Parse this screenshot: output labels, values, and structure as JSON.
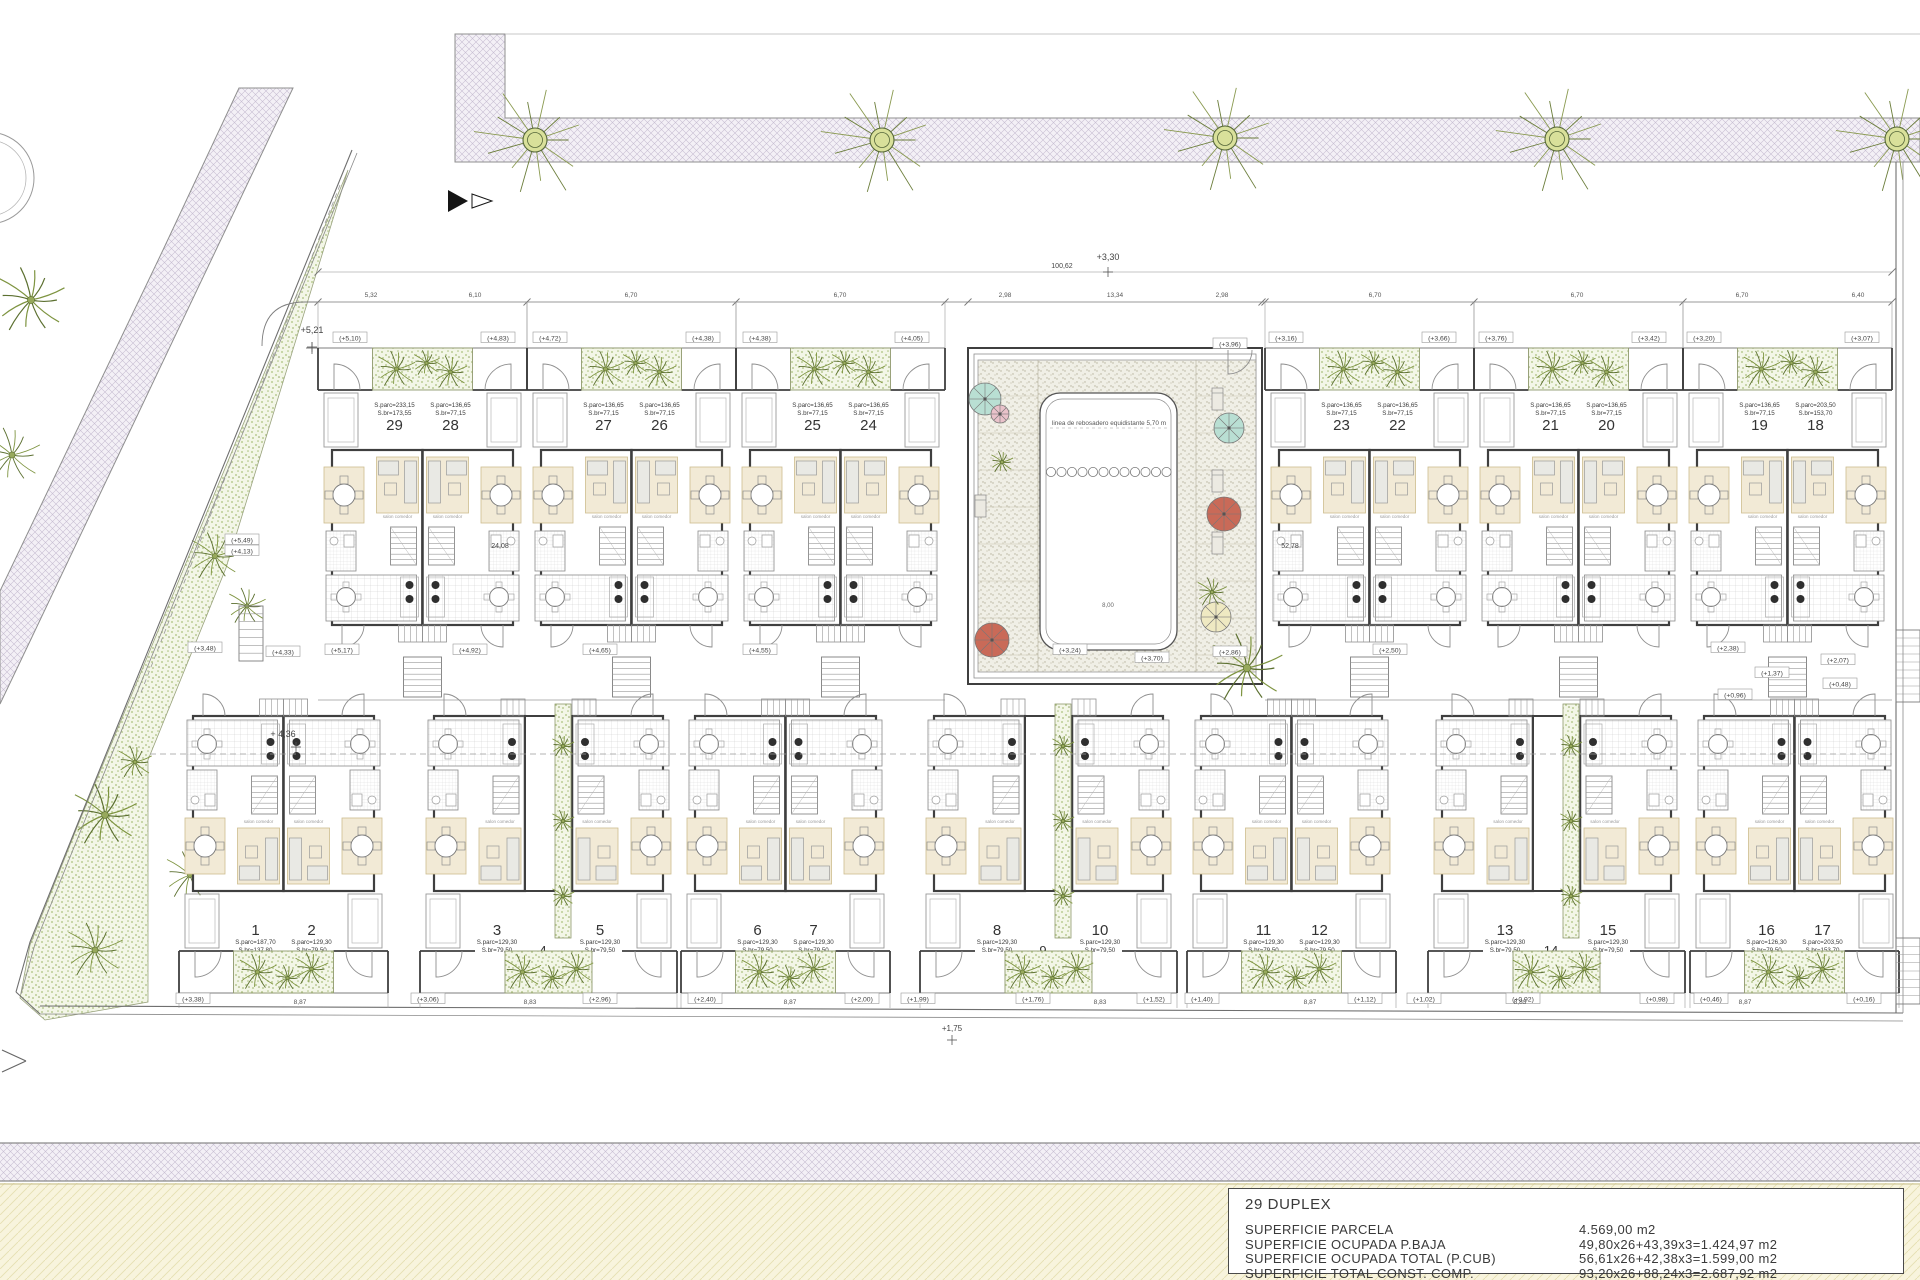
{
  "page": {
    "width": 1920,
    "height": 1280,
    "background": "#ffffff"
  },
  "colors": {
    "wall": "#3f3f3f",
    "line": "#6e6e6e",
    "faint": "#9a9a9a",
    "text": "#3a3a3a",
    "crosshatch_base": "#f3f0f6",
    "crosshatch_line": "#c6bdd2",
    "beige_base": "#f8f4dd",
    "beige_line": "#e6dfb2",
    "green_base": "#f3f6e7",
    "green_dot": "#a9bf7c",
    "plant": "#7e9440",
    "plant_dark": "#5c7030",
    "rug": "#f2ead6",
    "rug_line": "#cdbd8e",
    "deck_base": "#f0efe6",
    "deck_dot": "#b5b19c",
    "pool_edge": "#555555",
    "parasol_teal": "#b9dfd3",
    "parasol_pink": "#e9c2ca",
    "parasol_red": "#c96a58",
    "parasol_yellow": "#efe9c2"
  },
  "title_block": {
    "title": "29 DUPLEX",
    "rows": [
      {
        "label": "SUPERFICIE PARCELA",
        "value": "4.569,00 m2"
      },
      {
        "label": "SUPERFICIE OCUPADA P.BAJA",
        "value": "49,80x26+43,39x3=1.424,97 m2"
      },
      {
        "label": "SUPERFICIE OCUPADA TOTAL (P.CUB)",
        "value": "56,61x26+42,38x3=1.599,00 m2"
      },
      {
        "label": "SUPERFICIE TOTAL CONST. COMP.",
        "value": "93,20x26+88,24x3=2.687,92 m2"
      }
    ]
  },
  "pool": {
    "note": "linea de rebosadero equidistante 5,70 m",
    "dim_inner": "8,00",
    "parasols": [
      {
        "x": 985,
        "y": 399,
        "r": 16,
        "color": "#b9dfd3"
      },
      {
        "x": 1000,
        "y": 414,
        "r": 9,
        "color": "#e9c2ca"
      },
      {
        "x": 1229,
        "y": 428,
        "r": 15,
        "color": "#b9dfd3"
      },
      {
        "x": 1224,
        "y": 514,
        "r": 17,
        "color": "#c96a58"
      },
      {
        "x": 992,
        "y": 640,
        "r": 17,
        "color": "#c96a58"
      },
      {
        "x": 1216,
        "y": 617,
        "r": 15,
        "color": "#efe9c2"
      }
    ],
    "loungers": [
      {
        "x": 1212,
        "y": 388
      },
      {
        "x": 1212,
        "y": 470
      },
      {
        "x": 1212,
        "y": 532
      },
      {
        "x": 975,
        "y": 495
      }
    ],
    "palms": [
      {
        "x": 1247,
        "y": 668,
        "r": 38
      },
      {
        "x": 1212,
        "y": 592,
        "r": 16
      },
      {
        "x": 1002,
        "y": 462,
        "r": 12
      }
    ]
  },
  "street_trees": [
    {
      "x": 535,
      "y": 140
    },
    {
      "x": 882,
      "y": 140
    },
    {
      "x": 1225,
      "y": 138
    },
    {
      "x": 1557,
      "y": 139
    },
    {
      "x": 1897,
      "y": 139
    }
  ],
  "garden_trees": [
    {
      "x": 105,
      "y": 815,
      "r": 34
    },
    {
      "x": 95,
      "y": 950,
      "r": 30
    },
    {
      "x": 190,
      "y": 875,
      "r": 26
    },
    {
      "x": 240,
      "y": 868,
      "r": 22
    },
    {
      "x": 215,
      "y": 556,
      "r": 26
    },
    {
      "x": 247,
      "y": 606,
      "r": 20
    },
    {
      "x": 135,
      "y": 762,
      "r": 18
    },
    {
      "x": 31,
      "y": 300,
      "r": 36
    },
    {
      "x": 12,
      "y": 455,
      "r": 30
    }
  ],
  "blocks": [
    {
      "name": "top-row",
      "y": 345,
      "flip": false,
      "groups": [
        {
          "type": "pair",
          "x": 318,
          "units": [
            {
              "num": "29",
              "a1": "S.parc=233,15",
              "a2": "S.br=173,55"
            },
            {
              "num": "28",
              "a1": "S.parc=136,65",
              "a2": "S.br=77,15"
            }
          ]
        },
        {
          "type": "pair",
          "x": 527,
          "units": [
            {
              "num": "27",
              "a1": "S.parc=136,65",
              "a2": "S.br=77,15"
            },
            {
              "num": "26",
              "a1": "S.parc=136,65",
              "a2": "S.br=77,15"
            }
          ]
        },
        {
          "type": "pair",
          "x": 736,
          "units": [
            {
              "num": "25",
              "a1": "S.parc=136,65",
              "a2": "S.br=77,15"
            },
            {
              "num": "24",
              "a1": "S.parc=136,65",
              "a2": "S.br=77,15"
            }
          ]
        },
        {
          "type": "pair",
          "x": 1265,
          "units": [
            {
              "num": "23",
              "a1": "S.parc=136,65",
              "a2": "S.br=77,15"
            },
            {
              "num": "22",
              "a1": "S.parc=136,65",
              "a2": "S.br=77,15"
            }
          ]
        },
        {
          "type": "pair",
          "x": 1474,
          "units": [
            {
              "num": "21",
              "a1": "S.parc=136,65",
              "a2": "S.br=77,15"
            },
            {
              "num": "20",
              "a1": "S.parc=136,65",
              "a2": "S.br=77,15"
            }
          ]
        },
        {
          "type": "pair",
          "x": 1683,
          "units": [
            {
              "num": "19",
              "a1": "S.parc=136,65",
              "a2": "S.br=77,15"
            },
            {
              "num": "18",
              "a1": "S.parc=203,50",
              "a2": "S.br=153,70"
            }
          ]
        }
      ]
    },
    {
      "name": "bottom-row",
      "y": 996,
      "flip": true,
      "groups": [
        {
          "type": "pair",
          "x": 179,
          "units": [
            {
              "num": "1",
              "a1": "S.parc=187,70",
              "a2": "S.br=137,80"
            },
            {
              "num": "2",
              "a1": "S.parc=129,30",
              "a2": "S.br=79,50"
            }
          ]
        },
        {
          "type": "triple",
          "x": 420,
          "units": [
            {
              "num": "3",
              "a1": "S.parc=129,30",
              "a2": "S.br=79,50"
            },
            {
              "num": "4",
              "a1": "S.parc=88,03",
              "a2": "S.br=42,84"
            },
            {
              "num": "5",
              "a1": "S.parc=129,30",
              "a2": "S.br=79,50"
            }
          ]
        },
        {
          "type": "pair",
          "x": 681,
          "units": [
            {
              "num": "6",
              "a1": "S.parc=129,30",
              "a2": "S.br=79,50"
            },
            {
              "num": "7",
              "a1": "S.parc=129,30",
              "a2": "S.br=79,50"
            }
          ]
        },
        {
          "type": "triple",
          "x": 920,
          "units": [
            {
              "num": "8",
              "a1": "S.parc=129,30",
              "a2": "S.br=79,50"
            },
            {
              "num": "9",
              "a1": "S.parc=88,03",
              "a2": "S.br=42,84"
            },
            {
              "num": "10",
              "a1": "S.parc=129,30",
              "a2": "S.br=79,50"
            }
          ]
        },
        {
          "type": "pair",
          "x": 1187,
          "units": [
            {
              "num": "11",
              "a1": "S.parc=129,30",
              "a2": "S.br=79,50"
            },
            {
              "num": "12",
              "a1": "S.parc=129,30",
              "a2": "S.br=79,50"
            }
          ]
        },
        {
          "type": "triple",
          "x": 1428,
          "units": [
            {
              "num": "13",
              "a1": "S.parc=129,30",
              "a2": "S.br=79,50"
            },
            {
              "num": "14",
              "a1": "S.parc=88,03",
              "a2": "S.br=42,84"
            },
            {
              "num": "15",
              "a1": "S.parc=129,30",
              "a2": "S.br=79,50"
            }
          ]
        },
        {
          "type": "pair",
          "x": 1690,
          "units": [
            {
              "num": "16",
              "a1": "S.parc=126,30",
              "a2": "S.br=79,50"
            },
            {
              "num": "17",
              "a1": "S.parc=203,50",
              "a2": "S.br=153,70"
            }
          ]
        }
      ]
    }
  ],
  "site_labels": [
    {
      "t": "+5,21",
      "x": 312,
      "y": 333,
      "s": 9
    },
    {
      "t": "+3,30",
      "x": 1108,
      "y": 260,
      "s": 9
    },
    {
      "t": "+ 4,36",
      "x": 283,
      "y": 737,
      "s": 9
    },
    {
      "t": "+1,75",
      "x": 952,
      "y": 1031,
      "s": 8
    },
    {
      "t": "100,62",
      "x": 1062,
      "y": 268,
      "s": 7
    },
    {
      "t": "24,08",
      "x": 500,
      "y": 548,
      "s": 7
    },
    {
      "t": "52,78",
      "x": 1290,
      "y": 548,
      "s": 7
    },
    {
      "t": "(+5,10)",
      "x": 350,
      "y": 338,
      "b": 1
    },
    {
      "t": "(+4,83)",
      "x": 498,
      "y": 338,
      "b": 1
    },
    {
      "t": "(+4,72)",
      "x": 550,
      "y": 338,
      "b": 1
    },
    {
      "t": "(+4,38)",
      "x": 703,
      "y": 338,
      "b": 1
    },
    {
      "t": "(+4,38)",
      "x": 760,
      "y": 338,
      "b": 1
    },
    {
      "t": "(+4,05)",
      "x": 912,
      "y": 338,
      "b": 1
    },
    {
      "t": "(+3,96)",
      "x": 1230,
      "y": 344,
      "b": 1
    },
    {
      "t": "(+3,16)",
      "x": 1286,
      "y": 338,
      "b": 1
    },
    {
      "t": "(+3,66)",
      "x": 1439,
      "y": 338,
      "b": 1
    },
    {
      "t": "(+3,76)",
      "x": 1496,
      "y": 338,
      "b": 1
    },
    {
      "t": "(+3,42)",
      "x": 1649,
      "y": 338,
      "b": 1
    },
    {
      "t": "(+3,20)",
      "x": 1704,
      "y": 338,
      "b": 1
    },
    {
      "t": "(+3,07)",
      "x": 1862,
      "y": 338,
      "b": 1
    },
    {
      "t": "(+5,49)",
      "x": 242,
      "y": 540,
      "b": 1
    },
    {
      "t": "(+4,13)",
      "x": 242,
      "y": 551,
      "b": 1
    },
    {
      "t": "(+3,48)",
      "x": 205,
      "y": 648,
      "b": 1
    },
    {
      "t": "(+4,33)",
      "x": 283,
      "y": 652,
      "b": 1
    },
    {
      "t": "(+5,17)",
      "x": 342,
      "y": 650,
      "b": 1
    },
    {
      "t": "(+4,92)",
      "x": 470,
      "y": 650,
      "b": 1
    },
    {
      "t": "(+4,65)",
      "x": 600,
      "y": 650,
      "b": 1
    },
    {
      "t": "(+4,55)",
      "x": 760,
      "y": 650,
      "b": 1
    },
    {
      "t": "(+3,70)",
      "x": 1152,
      "y": 658,
      "b": 1
    },
    {
      "t": "(+3,24)",
      "x": 1070,
      "y": 650,
      "b": 1
    },
    {
      "t": "(+2,86)",
      "x": 1230,
      "y": 652,
      "b": 1
    },
    {
      "t": "(+2,50)",
      "x": 1390,
      "y": 650,
      "b": 1
    },
    {
      "t": "(+2,38)",
      "x": 1728,
      "y": 648,
      "b": 1
    },
    {
      "t": "(+2,07)",
      "x": 1838,
      "y": 660,
      "b": 1
    },
    {
      "t": "(+1,37)",
      "x": 1772,
      "y": 673,
      "b": 1
    },
    {
      "t": "(+0,48)",
      "x": 1840,
      "y": 684,
      "b": 1
    },
    {
      "t": "(+0,96)",
      "x": 1735,
      "y": 695,
      "b": 1
    },
    {
      "t": "(+3,38)",
      "x": 193,
      "y": 999,
      "b": 1
    },
    {
      "t": "(+3,06)",
      "x": 428,
      "y": 999,
      "b": 1
    },
    {
      "t": "(+2,96)",
      "x": 600,
      "y": 999,
      "b": 1
    },
    {
      "t": "(+2,40)",
      "x": 705,
      "y": 999,
      "b": 1
    },
    {
      "t": "(+2,00)",
      "x": 862,
      "y": 999,
      "b": 1
    },
    {
      "t": "(+1,99)",
      "x": 918,
      "y": 999,
      "b": 1
    },
    {
      "t": "(+1,76)",
      "x": 1033,
      "y": 999,
      "b": 1
    },
    {
      "t": "(+1,52)",
      "x": 1154,
      "y": 999,
      "b": 1
    },
    {
      "t": "(+1,40)",
      "x": 1202,
      "y": 999,
      "b": 1
    },
    {
      "t": "(+1,12)",
      "x": 1365,
      "y": 999,
      "b": 1
    },
    {
      "t": "(+1,02)",
      "x": 1424,
      "y": 999,
      "b": 1
    },
    {
      "t": "(+0,92)",
      "x": 1523,
      "y": 999,
      "b": 1
    },
    {
      "t": "(+0,98)",
      "x": 1657,
      "y": 999,
      "b": 1
    },
    {
      "t": "(+0,46)",
      "x": 1711,
      "y": 999,
      "b": 1
    },
    {
      "t": "(+0,16)",
      "x": 1864,
      "y": 999,
      "b": 1
    }
  ],
  "dims": [
    {
      "t": "5,32",
      "x": 371,
      "y": 297
    },
    {
      "t": "6,10",
      "x": 475,
      "y": 297
    },
    {
      "t": "6,70",
      "x": 631,
      "y": 297
    },
    {
      "t": "6,70",
      "x": 840,
      "y": 297
    },
    {
      "t": "2,98",
      "x": 1005,
      "y": 297
    },
    {
      "t": "13,34",
      "x": 1115,
      "y": 297
    },
    {
      "t": "2,98",
      "x": 1222,
      "y": 297
    },
    {
      "t": "6,70",
      "x": 1375,
      "y": 297
    },
    {
      "t": "6,70",
      "x": 1577,
      "y": 297
    },
    {
      "t": "6,70",
      "x": 1742,
      "y": 297
    },
    {
      "t": "6,40",
      "x": 1858,
      "y": 297
    },
    {
      "t": "8,87",
      "x": 300,
      "y": 1004
    },
    {
      "t": "8,83",
      "x": 530,
      "y": 1004
    },
    {
      "t": "8,87",
      "x": 790,
      "y": 1004
    },
    {
      "t": "8,83",
      "x": 1100,
      "y": 1004
    },
    {
      "t": "8,87",
      "x": 1310,
      "y": 1004
    },
    {
      "t": "8,83",
      "x": 1520,
      "y": 1004
    },
    {
      "t": "8,87",
      "x": 1745,
      "y": 1004
    }
  ]
}
